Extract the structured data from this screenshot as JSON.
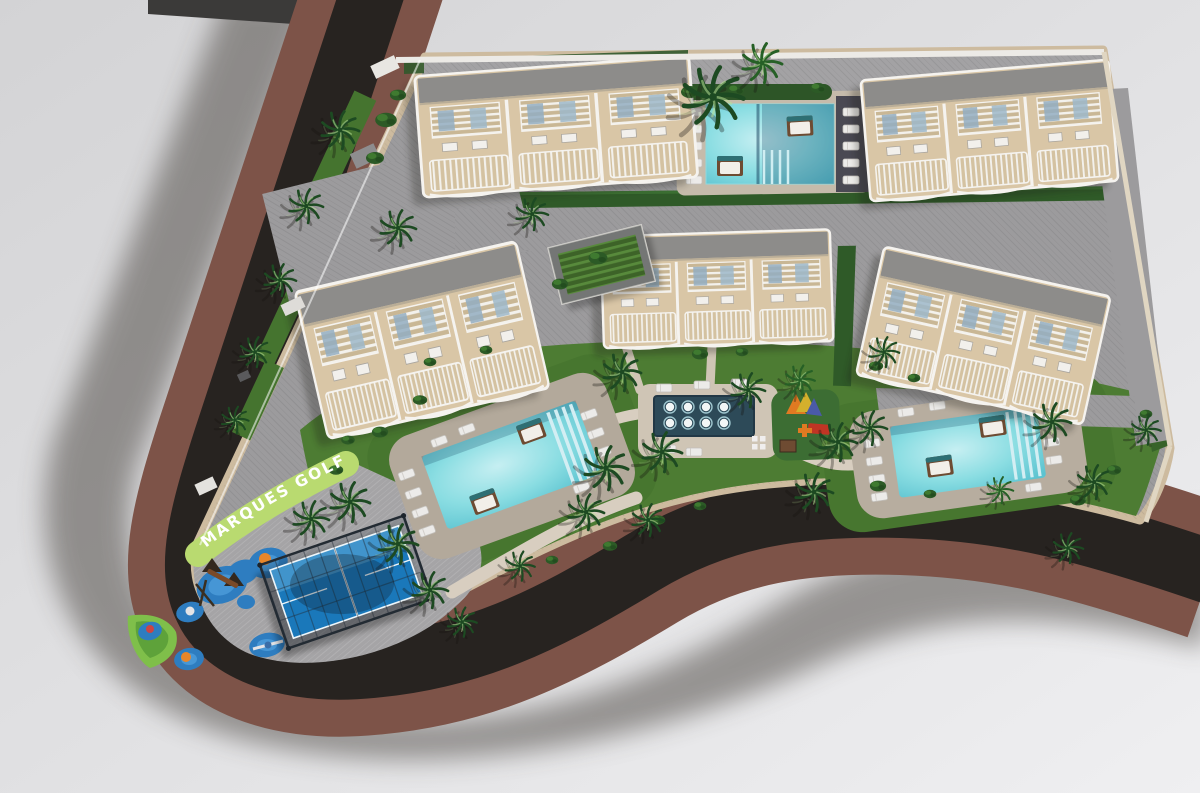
{
  "meta": {
    "title": "Aerial 3D site-plan render of a residential resort development"
  },
  "labels": {
    "street_name": "MARQUES GOLF"
  },
  "colors": {
    "background_top": "#d3d3d5",
    "background_bottom": "#efeff1",
    "road_asphalt": "#272320",
    "sidewalk_brown": "#7d5348",
    "paving_grey": "#9c9b9d",
    "playground_paving": "#a5a4a6",
    "lawn_green": "#4d7c33",
    "hedge_green": "#2f5a28",
    "pool_water": "#7fd6de",
    "deck_beige": "#b5ab9e",
    "building_beige": "#d9c6a6",
    "roof_grey": "#8d8c8a",
    "padel_blue": "#1a78ba",
    "play_blue": "#2e7dc0",
    "splash_navy": "#2d4a58",
    "sign_green": "#b9da70",
    "text_white": "#ffffff"
  },
  "scene": {
    "buildings": [
      {
        "id": "top-left-block",
        "units": 3
      },
      {
        "id": "top-right-block",
        "units": 3
      },
      {
        "id": "mid-left-block",
        "units": 3
      },
      {
        "id": "center-block",
        "units": 3
      },
      {
        "id": "right-block",
        "units": 3
      }
    ],
    "amenities": [
      "main-pool-top",
      "lap-pool-left",
      "lap-pool-right",
      "splash-pad",
      "kids-play-area",
      "toddler-playground",
      "padel-court"
    ],
    "splash_jets": {
      "rows": 2,
      "cols": 4,
      "x0": 670,
      "y0": 407,
      "dx": 18,
      "dy": 16
    },
    "palms": [
      [
        713,
        97,
        1.6
      ],
      [
        762,
        63,
        1.05,
        "#266026"
      ],
      [
        340,
        130,
        1.0
      ],
      [
        306,
        206,
        0.9
      ],
      [
        280,
        280,
        0.85
      ],
      [
        255,
        352,
        0.8
      ],
      [
        235,
        420,
        0.72
      ],
      [
        350,
        502,
        1.05
      ],
      [
        311,
        519,
        0.95
      ],
      [
        398,
        228,
        0.95
      ],
      [
        532,
        214,
        0.85
      ],
      [
        622,
        372,
        1.0
      ],
      [
        606,
        468,
        1.15
      ],
      [
        662,
        452,
        1.05
      ],
      [
        586,
        512,
        0.95
      ],
      [
        748,
        390,
        0.9
      ],
      [
        800,
        380,
        0.78,
        "#266026"
      ],
      [
        838,
        442,
        1.0
      ],
      [
        870,
        428,
        0.9
      ],
      [
        814,
        492,
        1.0
      ],
      [
        884,
        352,
        0.8
      ],
      [
        1052,
        422,
        1.0
      ],
      [
        1094,
        482,
        0.9
      ],
      [
        1146,
        430,
        0.78
      ],
      [
        1000,
        490,
        0.7,
        "#266026"
      ],
      [
        398,
        544,
        1.05
      ],
      [
        430,
        590,
        0.95
      ],
      [
        462,
        622,
        0.78
      ],
      [
        648,
        520,
        0.85
      ],
      [
        520,
        566,
        0.78
      ],
      [
        1068,
        548,
        0.8
      ]
    ],
    "bushes": [
      [
        386,
        120,
        1.2
      ],
      [
        375,
        158,
        1.0
      ],
      [
        398,
        95,
        0.9
      ],
      [
        690,
        92,
        1.0
      ],
      [
        736,
        90,
        0.9
      ],
      [
        818,
        88,
        0.85
      ],
      [
        598,
        258,
        1.05
      ],
      [
        560,
        284,
        0.9
      ],
      [
        700,
        354,
        0.9
      ],
      [
        742,
        352,
        0.7
      ],
      [
        876,
        366,
        0.8
      ],
      [
        914,
        378,
        0.7
      ],
      [
        658,
        520,
        0.8
      ],
      [
        700,
        506,
        0.7
      ],
      [
        878,
        486,
        0.9
      ],
      [
        930,
        494,
        0.7
      ],
      [
        1078,
        500,
        0.9
      ],
      [
        1114,
        470,
        0.8
      ],
      [
        1146,
        414,
        0.7
      ],
      [
        420,
        400,
        0.8
      ],
      [
        380,
        432,
        0.9
      ],
      [
        336,
        470,
        0.8
      ],
      [
        430,
        362,
        0.7
      ],
      [
        552,
        560,
        0.7
      ],
      [
        610,
        546,
        0.8
      ],
      [
        486,
        350,
        0.7
      ],
      [
        348,
        440,
        0.75
      ]
    ],
    "loungers": {
      "pool_top": [
        [
          694,
          112
        ],
        [
          694,
          129
        ],
        [
          694,
          146
        ],
        [
          694,
          163
        ],
        [
          694,
          180
        ],
        [
          851,
          112
        ],
        [
          851,
          129
        ],
        [
          851,
          146
        ],
        [
          851,
          163
        ],
        [
          851,
          180
        ]
      ],
      "pool_left": [
        [
          -102,
          -28
        ],
        [
          -102,
          -8
        ],
        [
          -102,
          12
        ],
        [
          -102,
          32
        ],
        [
          90,
          -22
        ],
        [
          90,
          -2
        ],
        [
          90,
          18
        ],
        [
          58,
          44
        ],
        [
          -60,
          -48
        ],
        [
          -30,
          -50
        ]
      ],
      "pool_right": [
        [
          -94,
          -22
        ],
        [
          -94,
          -4
        ],
        [
          -94,
          14
        ],
        [
          -94,
          32
        ],
        [
          84,
          -16
        ],
        [
          84,
          2
        ],
        [
          84,
          20
        ],
        [
          -56,
          -48
        ],
        [
          -24,
          -50
        ],
        [
          60,
          44
        ]
      ],
      "splash": [
        [
          664,
          388
        ],
        [
          702,
          385
        ],
        [
          739,
          383
        ],
        [
          668,
          449
        ],
        [
          694,
          452
        ]
      ]
    }
  }
}
